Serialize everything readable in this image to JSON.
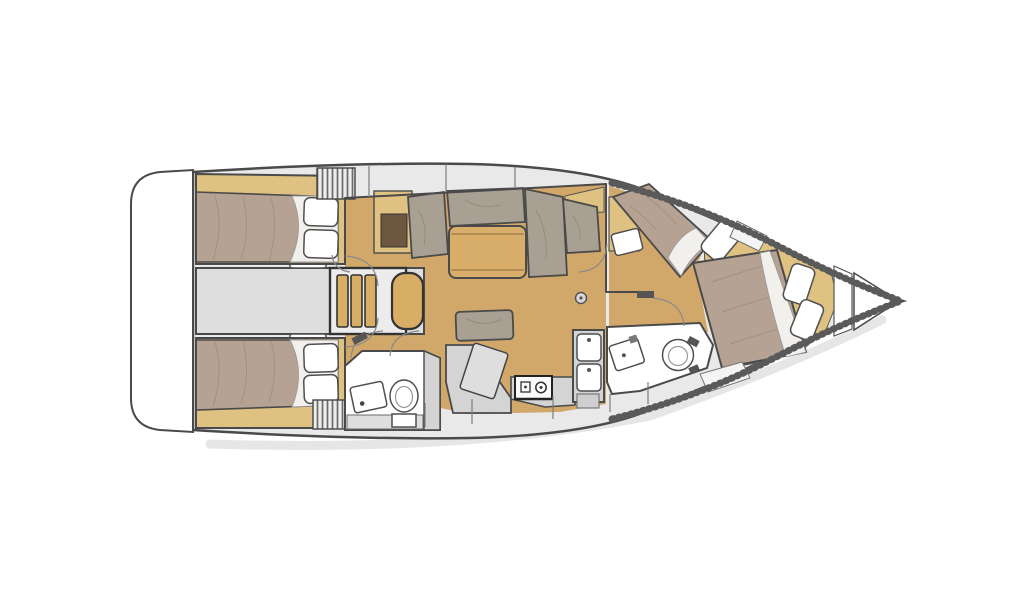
{
  "diagram": {
    "kind": "sailboat-interior-floor-plan",
    "view": "top-down",
    "orientation": "bow-right",
    "elements": [
      "hull",
      "transom-swim-platform",
      "bow-rail-texture",
      "bow-anchor-locker",
      "aft-cabin-port",
      "aft-cabin-starboard",
      "engine-corridor",
      "companionway-stairs",
      "cockpit-hatch-port",
      "cockpit-hatch-starboard",
      "storage-locker",
      "salon-sofa",
      "salon-table",
      "salon-bench",
      "mast-post",
      "aft-head",
      "aft-head-toilet",
      "aft-head-sink",
      "nav-chart-table",
      "galley-counter",
      "stove",
      "double-sink",
      "forward-head",
      "forward-head-toilet",
      "forward-head-sink",
      "forward-cabin",
      "diagonal-berth",
      "island-berth",
      "vanity-seat",
      "pillows"
    ]
  },
  "colors": {
    "background": "#ffffff",
    "hull_outline": "#4a4a4a",
    "deck": "#e9e9e9",
    "deck_panel": "#f4f4f4",
    "wood_floor": "#d2a86a",
    "wood_trim": "#dfc182",
    "wood_steps": "#d8ad66",
    "table_wood": "#d9ae6b",
    "bed_fabric": "#b5a292",
    "sofa_fabric": "#a9a094",
    "corridor_gray": "#dedede",
    "stair_box": "#ececec",
    "counter_gray": "#d4d4d4",
    "counter_light": "#dedede",
    "cabinet_gray": "#cfcfcf",
    "dark_locker": "#6e5740",
    "fixture_white": "#ffffff",
    "shadow": "#d2d2d2"
  }
}
